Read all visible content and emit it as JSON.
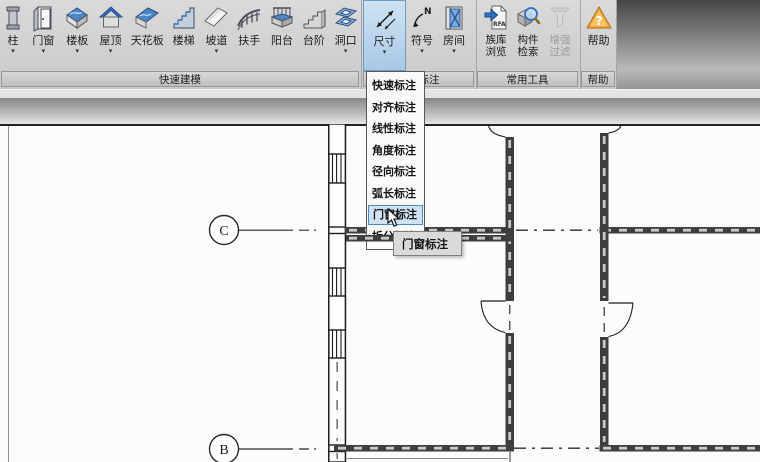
{
  "ribbon": {
    "groups": [
      {
        "label": "快速建模",
        "buttons": [
          {
            "label": "柱"
          },
          {
            "label": "门窗"
          },
          {
            "label": "楼板"
          },
          {
            "label": "屋顶"
          },
          {
            "label": "天花板"
          },
          {
            "label": "楼梯"
          },
          {
            "label": "坡道"
          },
          {
            "label": "扶手"
          },
          {
            "label": "阳台"
          },
          {
            "label": "台阶"
          },
          {
            "label": "洞口"
          }
        ]
      },
      {
        "label": "快速标注",
        "buttons": [
          {
            "label": "尺寸"
          },
          {
            "label": "符号"
          },
          {
            "label": "房间"
          }
        ]
      },
      {
        "label": "常用工具",
        "buttons": [
          {
            "line1": "族库",
            "line2": "浏览"
          },
          {
            "line1": "构件",
            "line2": "检索"
          },
          {
            "line1": "增强",
            "line2": "过滤"
          }
        ]
      },
      {
        "label": "帮助",
        "buttons": [
          {
            "label": "帮助"
          }
        ]
      }
    ]
  },
  "icons": {
    "caret": "▾",
    "rfa_text": "RFA",
    "north_letter": "N",
    "help_mark": "?"
  },
  "dropdown": {
    "items": [
      "快速标注",
      "对齐标注",
      "线性标注",
      "角度标注",
      "径向标注",
      "弧长标注",
      "门窗标注",
      "拆分标注"
    ],
    "selected": "门窗标注"
  },
  "tooltip": {
    "text": "门窗标注"
  },
  "drawing": {
    "grid_bubbles": [
      {
        "label": "C"
      },
      {
        "label": "B"
      }
    ]
  },
  "colors": {
    "active_button": "#a9c9e5",
    "menu_select_border": "#4a8ac2",
    "menu_select_bg": "#cfe2f4",
    "accent_blue": "#4a86c8",
    "help_orange": "#f2a93b"
  }
}
